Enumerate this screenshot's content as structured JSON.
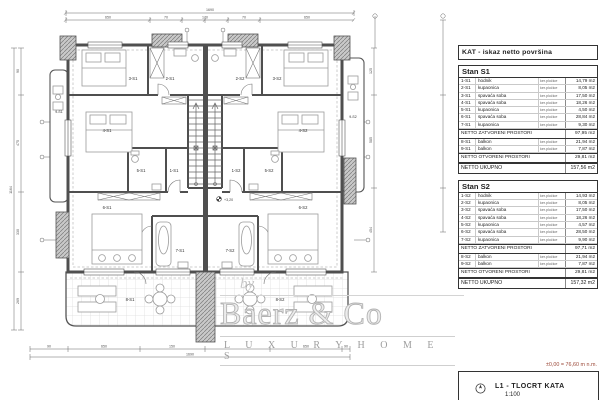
{
  "table": {
    "title": "KAT - iskaz netto površina",
    "material_note": "ker.pločice",
    "sections": [
      {
        "name": "Stan S1",
        "rows": [
          {
            "code": "1-S1",
            "label": "hodnik",
            "material": "ker.pločice",
            "area": "14,79 m2"
          },
          {
            "code": "2-S1",
            "label": "kupaonica",
            "material": "ker.pločice",
            "area": "8,05 m2"
          },
          {
            "code": "3-S1",
            "label": "spavaća soba",
            "material": "ker.pločice",
            "area": "17,50 m2"
          },
          {
            "code": "4-S1",
            "label": "spavaća soba",
            "material": "ker.pločice",
            "area": "18,26 m2"
          },
          {
            "code": "5-S1",
            "label": "kupaonica",
            "material": "ker.pločice",
            "area": "4,50 m2"
          },
          {
            "code": "6-S1",
            "label": "spavaća soba",
            "material": "ker.pločice",
            "area": "28,84 m2"
          },
          {
            "code": "7-S1",
            "label": "kupaonica",
            "material": "ker.pločice",
            "area": "9,30 m2"
          }
        ],
        "closed_total_label": "NETTO ZATVORENI PROSTORI",
        "closed_total": "97,95 m2",
        "open_rows": [
          {
            "code": "8-S1",
            "label": "balkon",
            "material": "ker.pločice",
            "area": "21,94 m2"
          },
          {
            "code": "9-S1",
            "label": "balkon",
            "material": "ker.pločice",
            "area": "7,87 m2"
          }
        ],
        "open_total_label": "NETTO OTVORENI PROSTORI",
        "open_total": "29,81 m2",
        "grand_total_label": "NETTO UKUPNO",
        "grand_total": "157,56 m2"
      },
      {
        "name": "Stan S2",
        "rows": [
          {
            "code": "1-S2",
            "label": "hodnik",
            "material": "ker.pločice",
            "area": "14,93 m2"
          },
          {
            "code": "2-S2",
            "label": "kupaonica",
            "material": "ker.pločice",
            "area": "8,05 m2"
          },
          {
            "code": "3-S2",
            "label": "spavaća soba",
            "material": "ker.pločice",
            "area": "17,50 m2"
          },
          {
            "code": "4-S2",
            "label": "spavaća soba",
            "material": "ker.pločice",
            "area": "18,26 m2"
          },
          {
            "code": "5-S2",
            "label": "kupaonica",
            "material": "ker.pločice",
            "area": "4,57 m2"
          },
          {
            "code": "6-S2",
            "label": "spavaća soba",
            "material": "ker.pločice",
            "area": "28,50 m2"
          },
          {
            "code": "7-S2",
            "label": "kupaonica",
            "material": "ker.pločice",
            "area": "9,90 m2"
          }
        ],
        "closed_total_label": "NETTO ZATVORENI PROSTORI",
        "closed_total": "97,71 m2",
        "open_rows": [
          {
            "code": "8-S2",
            "label": "balkon",
            "material": "ker.pločice",
            "area": "21,94 m2"
          },
          {
            "code": "9-S2",
            "label": "balkon",
            "material": "ker.pločice",
            "area": "7,87 m2"
          }
        ],
        "open_total_label": "NETTO OTVORENI PROSTORI",
        "open_total": "29,81 m2",
        "grand_total_label": "NETTO UKUPNO",
        "grand_total": "157,32 m2"
      }
    ]
  },
  "title_block": {
    "elevation_note": "±0,00 = 76,60 m n.m.",
    "sheet": "L1 - TLOCRT KATA",
    "scale": "1:100"
  },
  "watermark": {
    "by": "by",
    "name": "Baerz & Co",
    "tagline": "L U X U R Y   H O M E S"
  },
  "plan": {
    "rooms": [
      "3-S1",
      "2-S1",
      "2-S2",
      "3-S2",
      "4-S1",
      "4-S2",
      "9-S1",
      "9-S2",
      "5-S1",
      "1-S1",
      "1-S2",
      "5-S2",
      "6-S1",
      "6-S2",
      "7-S1",
      "7-S2",
      "8-S1",
      "8-S2"
    ],
    "level_marker": "+3,20"
  },
  "dims": {
    "top_total": "1690",
    "top": [
      "650",
      "70",
      "170",
      "70",
      "650"
    ],
    "bottom_total": "1690",
    "bottom": [
      "90",
      "650",
      "150",
      "650",
      "90"
    ],
    "left_total": "1164",
    "left": [
      "90",
      "475",
      "330",
      "269"
    ],
    "right": [
      "125",
      "585",
      "454"
    ]
  }
}
